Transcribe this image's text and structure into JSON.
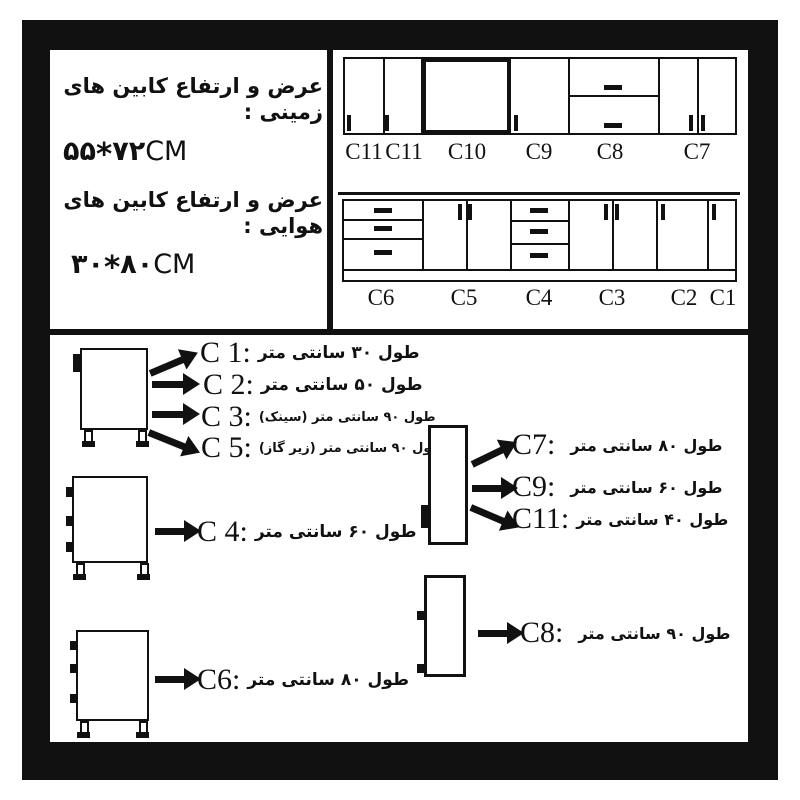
{
  "colors": {
    "ink": "#111111",
    "paper": "#ffffff"
  },
  "header": {
    "floor_title": "عرض و ارتفاع کابین های زمینی :",
    "floor_size": {
      "d1": "۵۵",
      "star": "*",
      "d2": "۷۲",
      "unit": "CM"
    },
    "wall_title": "عرض و ارتفاع کابین های هوایی :",
    "wall_size": {
      "d1": "۳۰",
      "star": "*",
      "d2": "۸۰",
      "unit": "CM"
    }
  },
  "wall_row": {
    "labels": [
      "C11",
      "C11",
      "C10",
      "C9",
      "C8",
      "C7"
    ]
  },
  "floor_row": {
    "labels": [
      "C6",
      "C5",
      "C4",
      "C3",
      "C2",
      "C1"
    ]
  },
  "legend": {
    "c1": {
      "code": "C 1:",
      "text": "طول ۳۰ سانتی متر"
    },
    "c2": {
      "code": "C 2:",
      "text": "طول ۵۰ سانتی متر"
    },
    "c3": {
      "code": "C 3:",
      "text": "طول ۹۰ سانتی متر (سینک)"
    },
    "c5": {
      "code": "C 5:",
      "text": "طول ۹۰ سانتی متر (زیر گاز)"
    },
    "c4": {
      "code": "C 4:",
      "text": "طول ۶۰ سانتی متر"
    },
    "c6": {
      "code": "C6:",
      "text": "طول ۸۰ سانتی متر"
    },
    "c7": {
      "code": "C7:",
      "text": "طول ۸۰ سانتی متر"
    },
    "c9": {
      "code": "C9:",
      "text": "طول ۶۰ سانتی متر"
    },
    "c11": {
      "code": "C11:",
      "text": "طول ۴۰ سانتی متر"
    },
    "c8": {
      "code": "C8:",
      "text": "طول ۹۰ سانتی متر"
    }
  }
}
